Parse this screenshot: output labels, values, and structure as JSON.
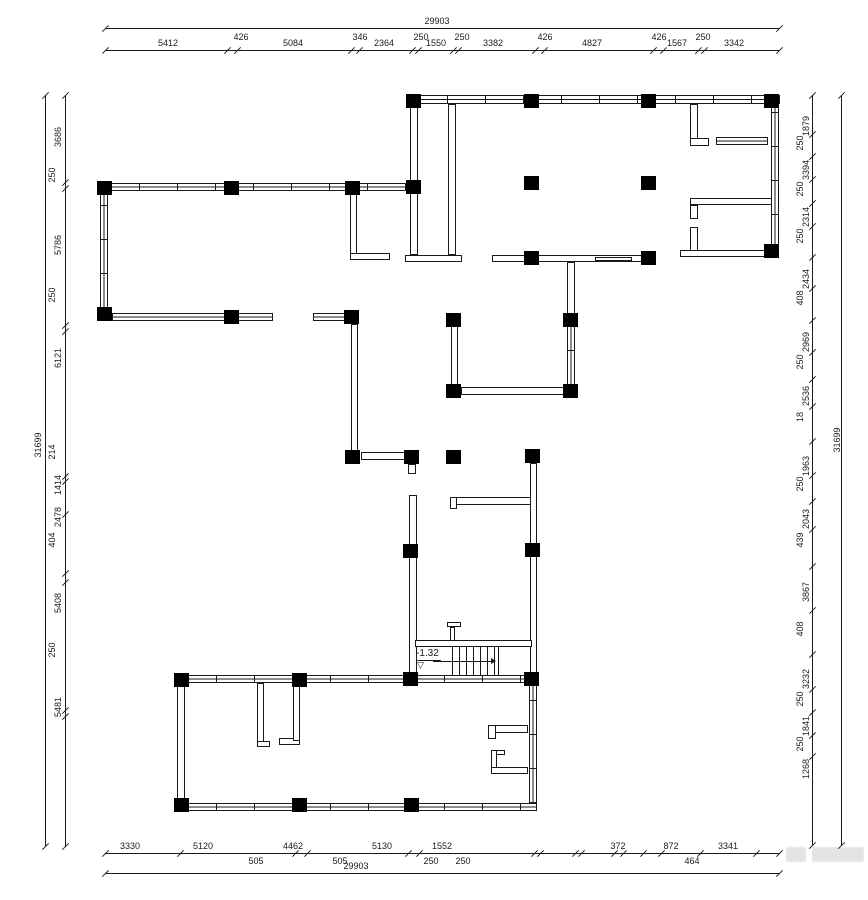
{
  "drawing": {
    "type": "architectural floor plan",
    "line_color": "#1a1a1a",
    "column_color": "#000000",
    "watermark_color": "#cfcfcf"
  },
  "dimensions": {
    "top": {
      "total": "29903",
      "total_pos": {
        "x": 437,
        "y": 26
      },
      "line_total": 28,
      "line_seg": 50,
      "extent": [
        105,
        779
      ],
      "ticks_total": [
        105,
        779
      ],
      "ticks": [
        105,
        227,
        237,
        351,
        359,
        412,
        418,
        453,
        458,
        535,
        544,
        653,
        663,
        698,
        704,
        779
      ],
      "labels": [
        {
          "t": "5412",
          "x": 168
        },
        {
          "t": "426",
          "x": 241,
          "raised": true
        },
        {
          "t": "5084",
          "x": 293
        },
        {
          "t": "346",
          "x": 360,
          "raised": true
        },
        {
          "t": "2364",
          "x": 384
        },
        {
          "t": "250",
          "x": 421,
          "raised": true
        },
        {
          "t": "1550",
          "x": 436
        },
        {
          "t": "250",
          "x": 462,
          "raised": true
        },
        {
          "t": "3382",
          "x": 493
        },
        {
          "t": "426",
          "x": 545,
          "raised": true
        },
        {
          "t": "4827",
          "x": 592
        },
        {
          "t": "426",
          "x": 659,
          "raised": true
        },
        {
          "t": "1567",
          "x": 677
        },
        {
          "t": "250",
          "x": 703,
          "raised": true
        },
        {
          "t": "3342",
          "x": 734
        }
      ]
    },
    "bottom": {
      "total": "29903",
      "total_pos": {
        "x": 356,
        "y": 871
      },
      "line_total": 873,
      "line_seg": 853,
      "extent": [
        105,
        779
      ],
      "ticks_total": [
        105,
        779
      ],
      "ticks": [
        105,
        180,
        295,
        307,
        408,
        419,
        534,
        540,
        575,
        581,
        614,
        623,
        643,
        661,
        700,
        756,
        779
      ],
      "labels": [
        {
          "t": "3330",
          "x": 130
        },
        {
          "t": "5120",
          "x": 203
        },
        {
          "t": "4462",
          "x": 293
        },
        {
          "t": "5130",
          "x": 382
        },
        {
          "t": "1552",
          "x": 442
        },
        {
          "t": "372",
          "x": 618
        },
        {
          "t": "872",
          "x": 671
        },
        {
          "t": "3341",
          "x": 728
        }
      ],
      "sub_labels": [
        {
          "t": "505",
          "x": 256
        },
        {
          "t": "505",
          "x": 340
        },
        {
          "t": "250",
          "x": 431
        },
        {
          "t": "250",
          "x": 463
        },
        {
          "t": "464",
          "x": 692
        }
      ]
    },
    "left": {
      "total": "31699",
      "total_pos": {
        "x": 38,
        "y": 445
      },
      "line_total": 45,
      "line_seg": 65,
      "extent": [
        95,
        846
      ],
      "ticks_total": [
        95,
        846
      ],
      "ticks": [
        95,
        182,
        188,
        325,
        331,
        476,
        481,
        514,
        573,
        582,
        710,
        716,
        846
      ],
      "labels": [
        {
          "t": "3686",
          "y": 137
        },
        {
          "t": "250",
          "y": 175,
          "raised": true
        },
        {
          "t": "5786",
          "y": 245
        },
        {
          "t": "250",
          "y": 295,
          "raised": true
        },
        {
          "t": "6121",
          "y": 358
        },
        {
          "t": "214",
          "y": 452,
          "raised": true
        },
        {
          "t": "1414",
          "y": 485
        },
        {
          "t": "2478",
          "y": 517
        },
        {
          "t": "404",
          "y": 540,
          "raised": true
        },
        {
          "t": "5408",
          "y": 603
        },
        {
          "t": "250",
          "y": 650,
          "raised": true
        },
        {
          "t": "5481",
          "y": 707
        }
      ]
    },
    "right": {
      "total": "31699",
      "total_pos": {
        "x": 837,
        "y": 440
      },
      "line_total": 841,
      "line_seg": 812,
      "extent": [
        95,
        845
      ],
      "ticks_total": [
        95,
        845
      ],
      "ticks": [
        95,
        134,
        156,
        179,
        203,
        226,
        257,
        288,
        320,
        352,
        379,
        406,
        441,
        475,
        501,
        529,
        566,
        610,
        654,
        689,
        712,
        735,
        756,
        845
      ],
      "labels": [
        {
          "t": "1879",
          "y": 126
        },
        {
          "t": "250",
          "y": 143,
          "raised": true
        },
        {
          "t": "3394",
          "y": 170
        },
        {
          "t": "250",
          "y": 189,
          "raised": true
        },
        {
          "t": "2314",
          "y": 217
        },
        {
          "t": "250",
          "y": 236,
          "raised": true
        },
        {
          "t": "2434",
          "y": 279
        },
        {
          "t": "408",
          "y": 298,
          "raised": true
        },
        {
          "t": "2969",
          "y": 342
        },
        {
          "t": "250",
          "y": 362,
          "raised": true
        },
        {
          "t": "2536",
          "y": 396
        },
        {
          "t": "18",
          "y": 417,
          "raised": true
        },
        {
          "t": "1963",
          "y": 466
        },
        {
          "t": "250",
          "y": 484,
          "raised": true
        },
        {
          "t": "2043",
          "y": 519
        },
        {
          "t": "439",
          "y": 540,
          "raised": true
        },
        {
          "t": "3867",
          "y": 592
        },
        {
          "t": "408",
          "y": 629,
          "raised": true
        },
        {
          "t": "3232",
          "y": 679
        },
        {
          "t": "250",
          "y": 699,
          "raised": true
        },
        {
          "t": "1841",
          "y": 726
        },
        {
          "t": "250",
          "y": 744,
          "raised": true
        },
        {
          "t": "1268",
          "y": 769
        }
      ]
    }
  },
  "plan": {
    "stairs": {
      "label": "-1.32",
      "level_symbol": "▽"
    },
    "walls": [
      [
        408,
        95,
        372,
        9,
        "wwh"
      ],
      [
        771,
        104,
        8,
        146,
        "wv"
      ],
      [
        410,
        104,
        8,
        151,
        "s"
      ],
      [
        448,
        104,
        8,
        151,
        "s"
      ],
      [
        405,
        255,
        57,
        7,
        "s"
      ],
      [
        492,
        255,
        163,
        7,
        "s"
      ],
      [
        595,
        257,
        37,
        4,
        "wh"
      ],
      [
        680,
        250,
        92,
        7,
        "s"
      ],
      [
        690,
        104,
        8,
        38,
        "s"
      ],
      [
        690,
        138,
        19,
        8,
        "s"
      ],
      [
        716,
        137,
        52,
        8,
        "wh"
      ],
      [
        690,
        198,
        82,
        7,
        "s"
      ],
      [
        690,
        205,
        8,
        14,
        "s"
      ],
      [
        690,
        227,
        8,
        24,
        "s"
      ],
      [
        100,
        183,
        314,
        8,
        "wwh"
      ],
      [
        100,
        191,
        8,
        118,
        "wv"
      ],
      [
        112,
        313,
        161,
        8,
        "wh"
      ],
      [
        313,
        313,
        33,
        8,
        "wh"
      ],
      [
        350,
        191,
        7,
        63,
        "s"
      ],
      [
        350,
        253,
        40,
        7,
        "s"
      ],
      [
        351,
        324,
        7,
        128,
        "s"
      ],
      [
        361,
        452,
        45,
        8,
        "s"
      ],
      [
        408,
        464,
        8,
        10,
        "s"
      ],
      [
        409,
        495,
        8,
        178,
        "s"
      ],
      [
        451,
        326,
        7,
        60,
        "s"
      ],
      [
        461,
        387,
        103,
        8,
        "s"
      ],
      [
        567,
        326,
        8,
        60,
        "wv"
      ],
      [
        567,
        262,
        8,
        54,
        "s"
      ],
      [
        450,
        497,
        82,
        8,
        "s"
      ],
      [
        450,
        497,
        7,
        12,
        "s"
      ],
      [
        530,
        463,
        7,
        210,
        "s"
      ],
      [
        415,
        640,
        117,
        7,
        "s"
      ],
      [
        447,
        622,
        14,
        5,
        "s"
      ],
      [
        450,
        627,
        5,
        14,
        "s"
      ],
      [
        177,
        675,
        360,
        8,
        "wwh"
      ],
      [
        177,
        683,
        8,
        121,
        "s"
      ],
      [
        177,
        803,
        360,
        8,
        "wwh"
      ],
      [
        529,
        683,
        8,
        121,
        "wv"
      ],
      [
        257,
        683,
        7,
        62,
        "s"
      ],
      [
        257,
        741,
        13,
        6,
        "s"
      ],
      [
        279,
        738,
        21,
        7,
        "s"
      ],
      [
        293,
        683,
        7,
        58,
        "s"
      ],
      [
        488,
        725,
        40,
        8,
        "s"
      ],
      [
        488,
        725,
        8,
        14,
        "s"
      ],
      [
        491,
        750,
        14,
        5,
        "s"
      ],
      [
        491,
        750,
        6,
        24,
        "s"
      ],
      [
        491,
        767,
        37,
        7,
        "s"
      ]
    ],
    "columns": [
      [
        406,
        94
      ],
      [
        524,
        94
      ],
      [
        641,
        94
      ],
      [
        764,
        94
      ],
      [
        764,
        244
      ],
      [
        524,
        176
      ],
      [
        641,
        176
      ],
      [
        524,
        251
      ],
      [
        641,
        251
      ],
      [
        97,
        181
      ],
      [
        224,
        181
      ],
      [
        345,
        181
      ],
      [
        406,
        180
      ],
      [
        97,
        307
      ],
      [
        224,
        310
      ],
      [
        344,
        310
      ],
      [
        345,
        450
      ],
      [
        404,
        450
      ],
      [
        446,
        450
      ],
      [
        525,
        449
      ],
      [
        446,
        313
      ],
      [
        563,
        313
      ],
      [
        446,
        384
      ],
      [
        563,
        384
      ],
      [
        403,
        544
      ],
      [
        525,
        543
      ],
      [
        403,
        672
      ],
      [
        524,
        672
      ],
      [
        174,
        673
      ],
      [
        292,
        673
      ],
      [
        174,
        798
      ],
      [
        292,
        798
      ],
      [
        404,
        798
      ]
    ]
  }
}
